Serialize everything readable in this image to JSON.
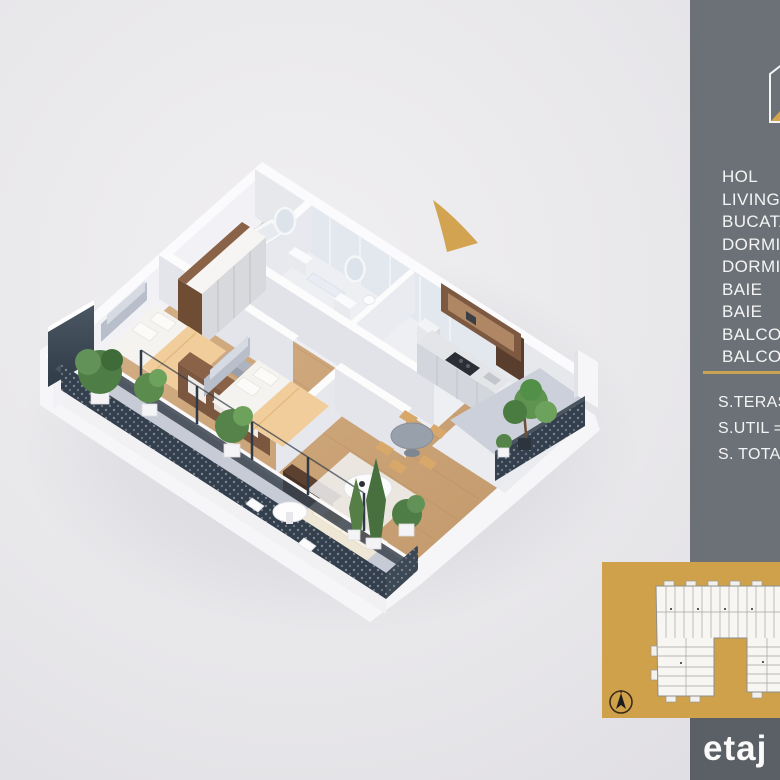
{
  "sidebar": {
    "rooms": [
      "HOL",
      "LIVING",
      "BUCATARIE",
      "DORMITOR",
      "DORMITOR",
      "BAIE",
      "BAIE",
      "BALCON",
      "BALCON"
    ],
    "areas": [
      "S.TERASA =",
      "S.UTIL =",
      "S. TOTALA ="
    ],
    "floor_label": "etaj"
  },
  "colors": {
    "sidebar_gray": "#6b7177",
    "strip_gray": "#5a6065",
    "accent_gold": "#cfa14b",
    "wood_floor": "#cfa87a",
    "terrace_floor": "#c7cbd6",
    "railing_dark": "#333f4d",
    "background": "#e8e7ea"
  },
  "icons": {
    "logo": "house-outline-logo",
    "compass": "north-compass",
    "arrow": "gold-direction-arrow"
  }
}
